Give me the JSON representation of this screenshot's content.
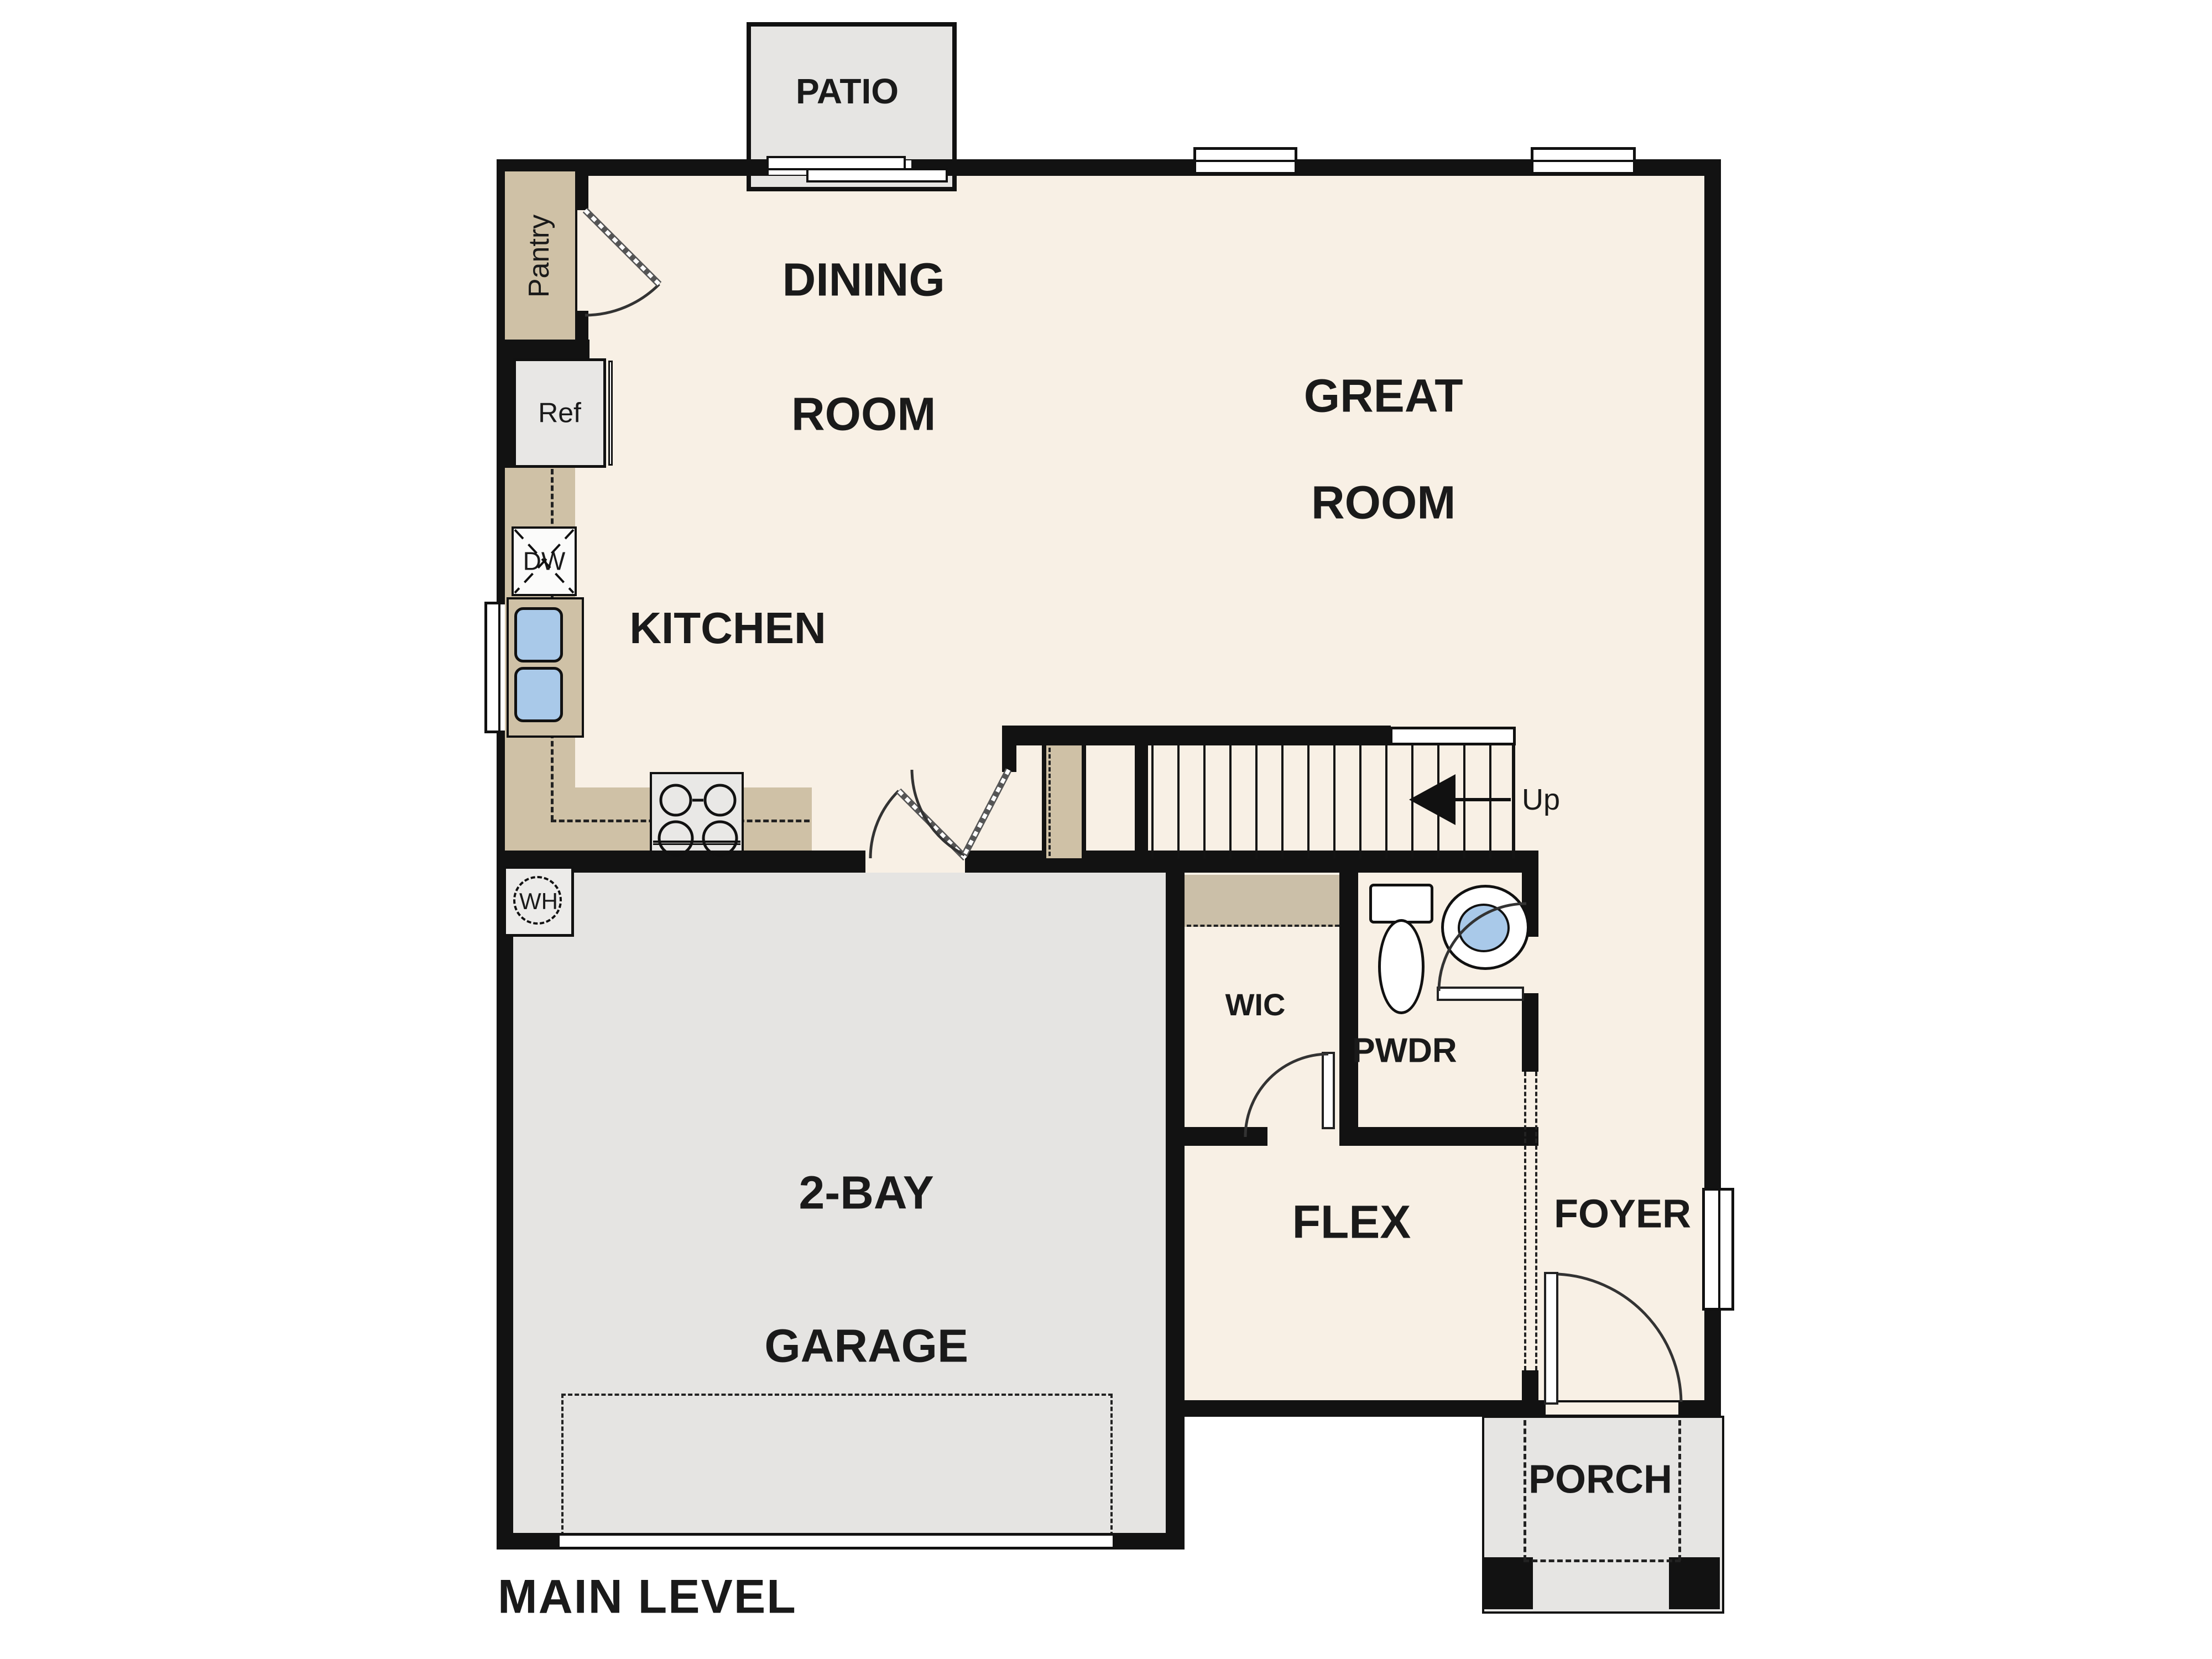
{
  "plan": {
    "title": "MAIN LEVEL"
  },
  "rooms": {
    "patio": {
      "label": "PATIO"
    },
    "dining": {
      "line1": "DINING",
      "line2": "ROOM"
    },
    "great": {
      "line1": "GREAT",
      "line2": "ROOM"
    },
    "kitchen": {
      "label": "KITCHEN"
    },
    "pantry": {
      "label": "Pantry"
    },
    "garage": {
      "line1": "2-BAY",
      "line2": "GARAGE"
    },
    "flex": {
      "label": "FLEX"
    },
    "foyer": {
      "label": "FOYER"
    },
    "porch": {
      "label": "PORCH"
    },
    "wic": {
      "label": "WIC"
    },
    "pwdr": {
      "label": "PWDR"
    }
  },
  "fixtures": {
    "refrigerator": "Ref",
    "dishwasher": "DW",
    "water_heater": "WH"
  },
  "stairs": {
    "up": "Up"
  },
  "colors": {
    "floor": "#f8f0e5",
    "wall": "#121212",
    "counter_tan": "#cfc1a6",
    "concrete": "#e6e5e3",
    "fixture_blue": "#a9c9e9"
  }
}
